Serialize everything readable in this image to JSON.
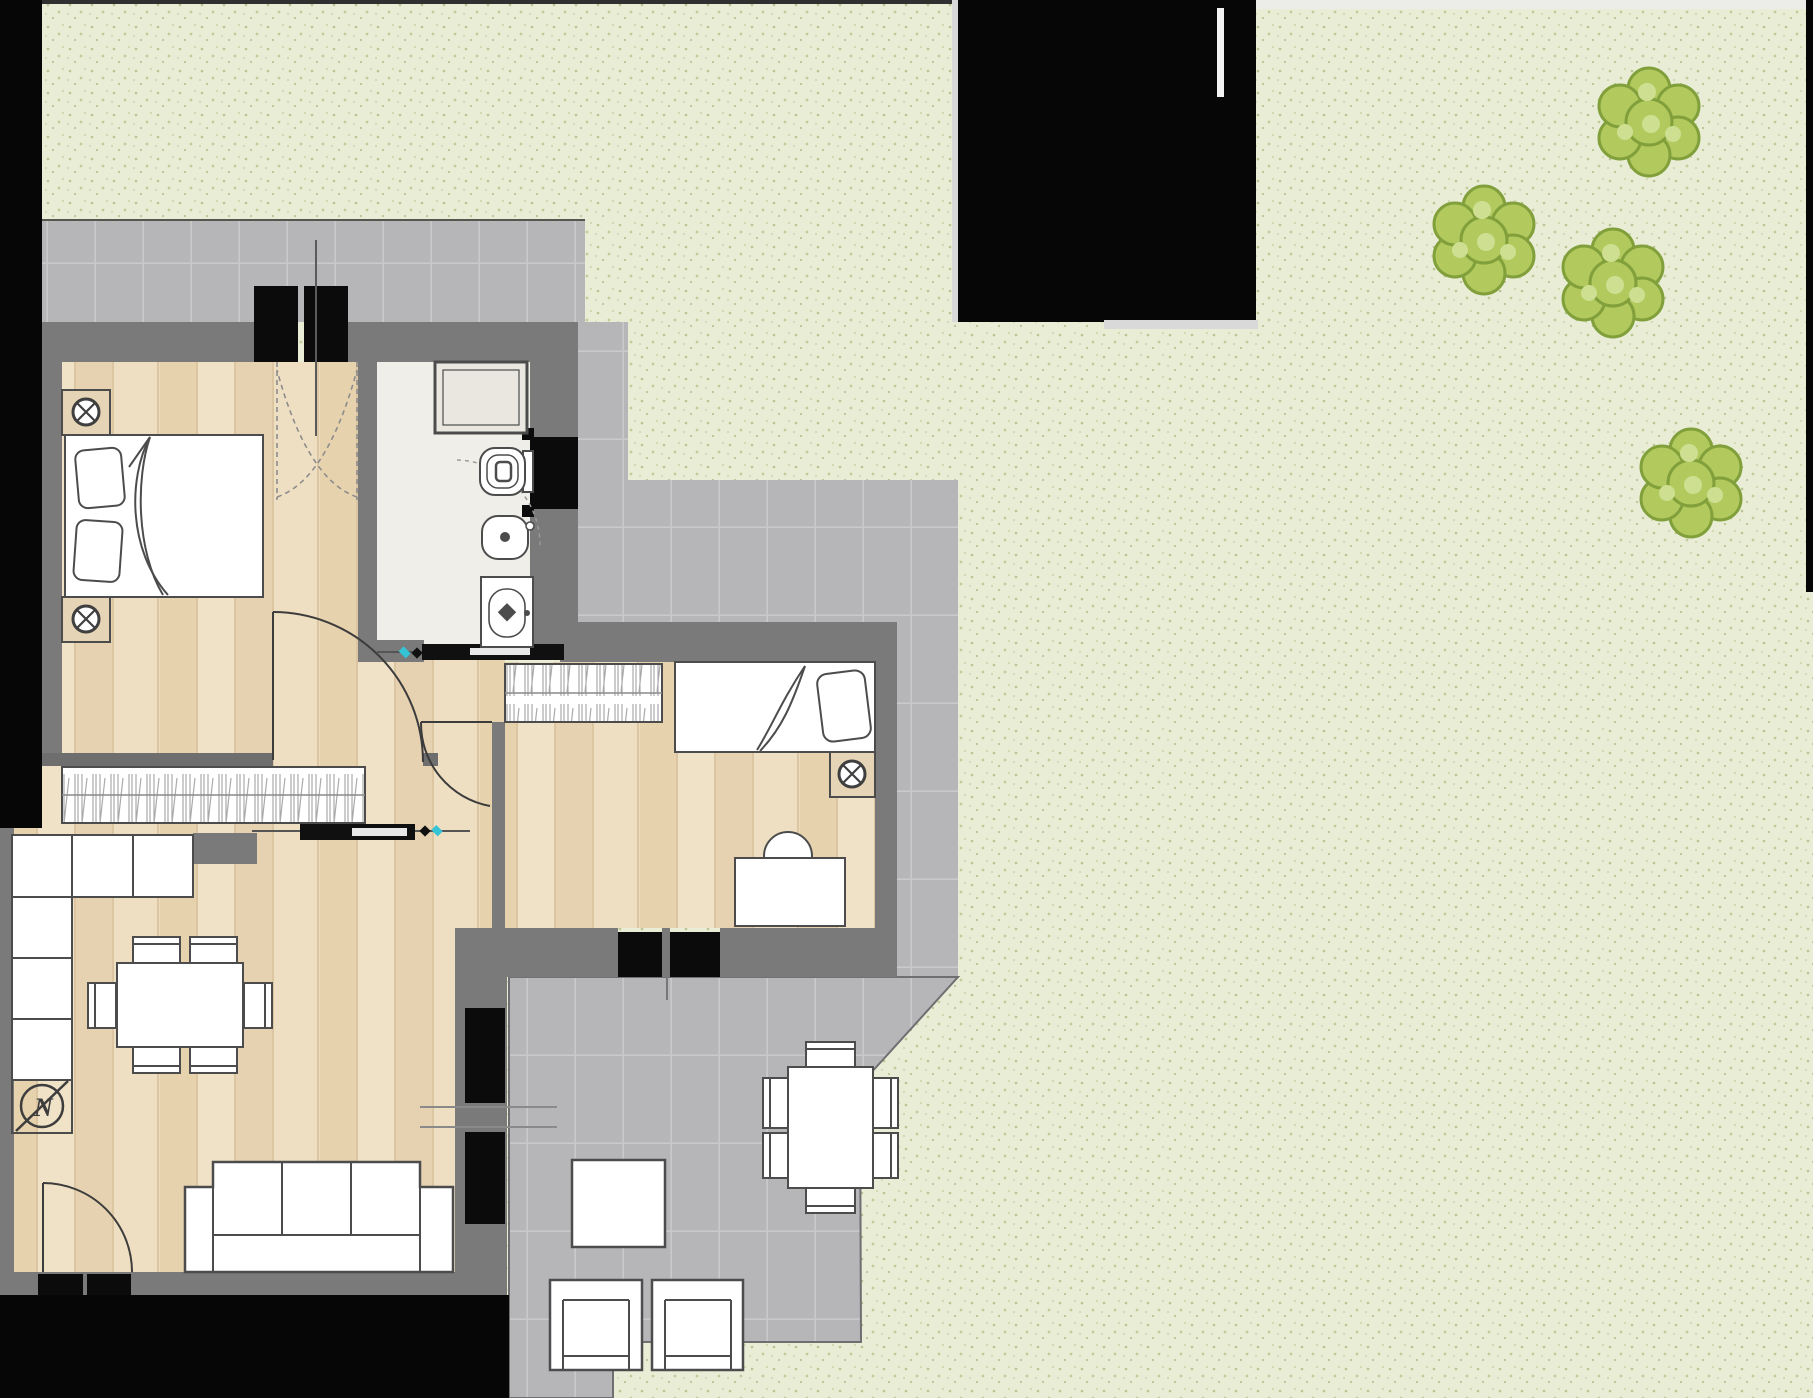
{
  "scene": {
    "type": "apartment-floor-plan-with-garden",
    "description": "Top-down architectural floor plan of a one/two-bedroom apartment surrounded by a dotted lawn, gray tiled terraces, shrubs, and black masked regions"
  },
  "compass": {
    "label": "N"
  },
  "colors": {
    "mask_black": "#060606",
    "grass_base": "#e9edd6",
    "grass_dot": "#b9c493",
    "tile_base": "#b6b6b9",
    "tile_grout": "#c9c9cc",
    "wall_gray": "#7a7a7a",
    "wood_floor": "#ecdbbc",
    "bathroom_floor": "#f0eee8",
    "furniture_fill": "#ffffff",
    "furniture_stroke": "#4c4c4c",
    "nightstand_fill": "#e6d4b6",
    "bush_fill": "#b2c95e",
    "bush_edge": "#81a03b",
    "bush_highlight": "#cfdf92",
    "accent_cyan": "#35c3d6"
  },
  "rooms": [
    {
      "name": "master-bedroom",
      "furniture": [
        "double-bed",
        "pillow",
        "pillow",
        "nightstand-with-lamp",
        "nightstand-with-lamp",
        "wardrobe",
        "balcony-double-door",
        "interior-door"
      ]
    },
    {
      "name": "bathroom",
      "furniture": [
        "shower-tray",
        "toilet",
        "bidet",
        "washbasin",
        "sliding-door",
        "window"
      ]
    },
    {
      "name": "second-bedroom",
      "furniture": [
        "wardrobe",
        "single-bed",
        "pillow",
        "nightstand-with-lamp",
        "desk",
        "desk-chair",
        "interior-door",
        "windows"
      ]
    },
    {
      "name": "living-room-kitchen",
      "furniture": [
        "l-shaped-kitchen-counter",
        "dining-table",
        "dining-chairs-x6",
        "sofa-3-seat",
        "compass-rose",
        "entrance-door",
        "tall-window",
        "sliding-door"
      ]
    }
  ],
  "outdoor": {
    "terraces": [
      "upper-tiled-terrace",
      "lower-tiled-terrace"
    ],
    "furniture": [
      "outdoor-table",
      "outdoor-chairs-x6",
      "side-table",
      "lounge-chair",
      "lounge-chair"
    ],
    "bush_count": 4
  },
  "masks": [
    "left-edge",
    "top-middle",
    "bottom-left",
    "right-edge"
  ]
}
